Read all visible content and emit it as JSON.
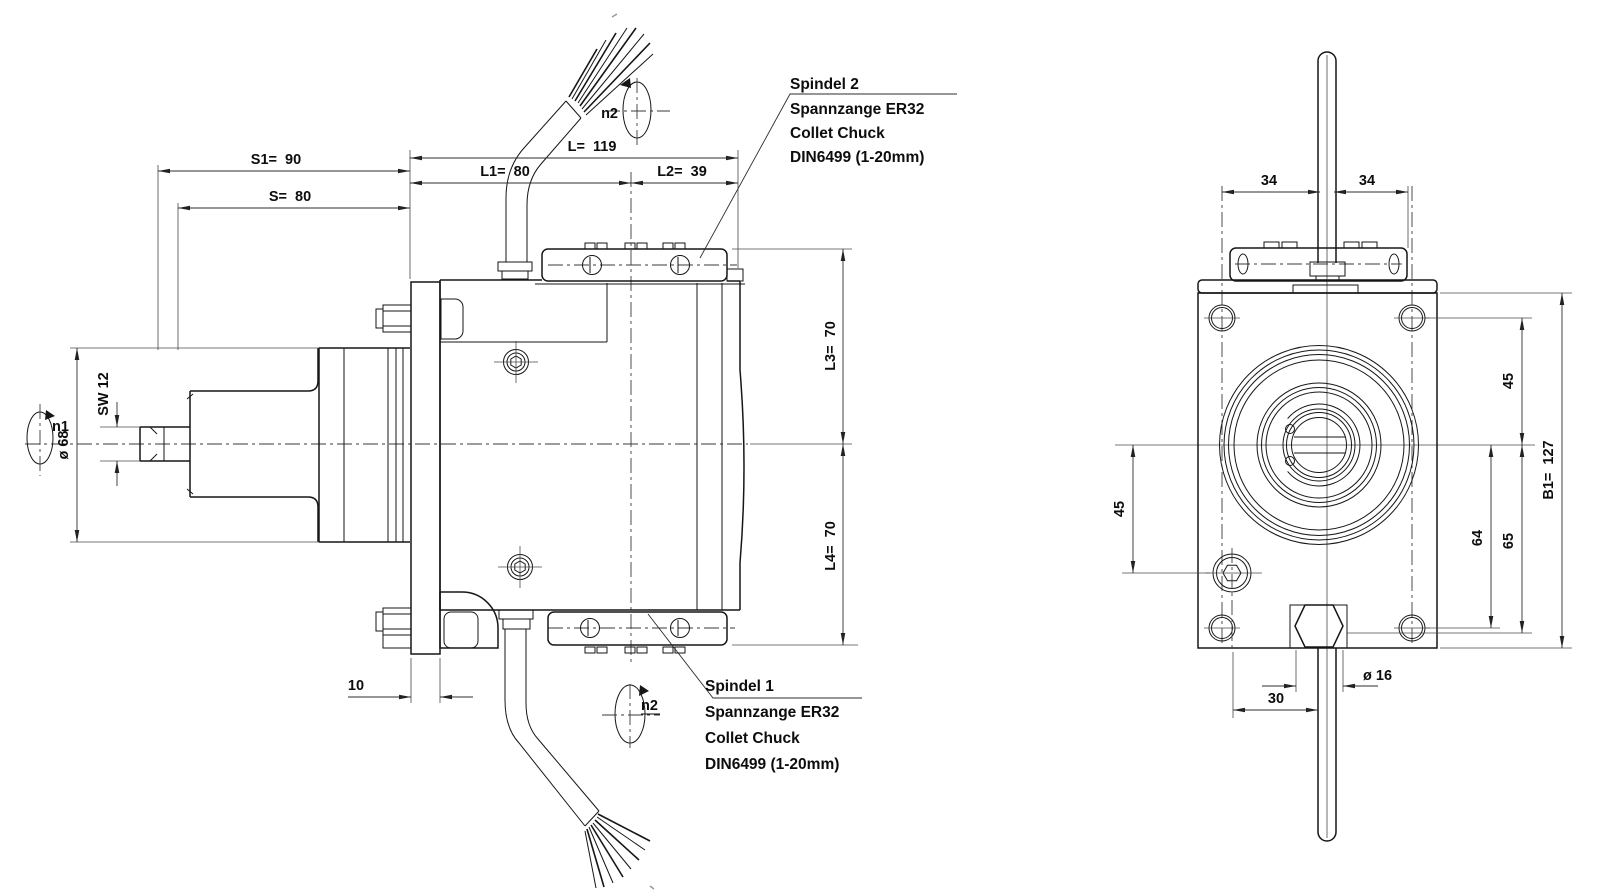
{
  "colors": {
    "line": "#161616",
    "dim": "#2e2e2e",
    "background": "#ffffff"
  },
  "dims": {
    "s1": "S1=  90",
    "s": "S=  80",
    "l": "L=  119",
    "l1": "L1=  80",
    "l2": "L2=  39",
    "l3": "L3=  70",
    "l4": "L4=  70",
    "dia68": "ø 68",
    "sw12": "SW 12",
    "plate10": "10",
    "spacing34_left": "34",
    "spacing34_right": "34",
    "right45": "45",
    "left45": "45",
    "v64": "64",
    "v65": "65",
    "b1": "B1=  127",
    "dia16": "ø 16",
    "h30": "30"
  },
  "rotation": {
    "n1": "n1",
    "n2_top": "n2",
    "n2_bottom": "n2"
  },
  "callouts": {
    "spindle2": {
      "title": "Spindel 2",
      "line2": "Spannzange ER32",
      "line3": "Collet Chuck",
      "line4": "DIN6499 (1-20mm)"
    },
    "spindle1": {
      "title": "Spindel 1",
      "line2": "Spannzange ER32",
      "line3": "Collet Chuck",
      "line4": "DIN6499 (1-20mm)"
    }
  }
}
